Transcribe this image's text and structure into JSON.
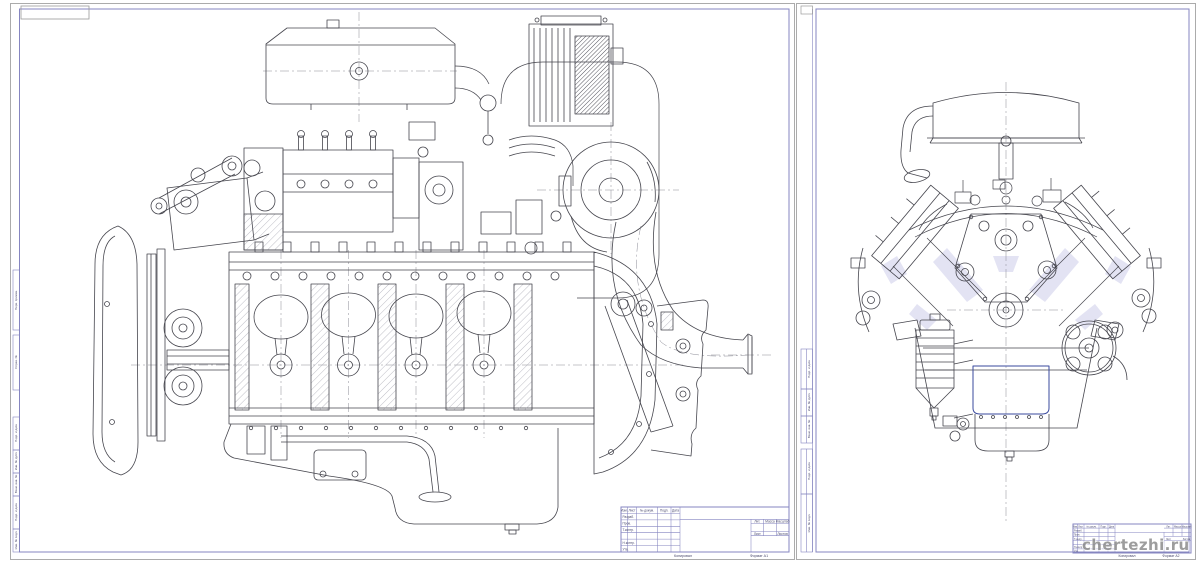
{
  "colors": {
    "background": "#ffffff",
    "frame_line": "#8585c0",
    "edge_line": "#a6a6a6",
    "drawing_line": "#46464e",
    "centerline": "#8b8b95",
    "accent_navy": "#3a4a9e",
    "hatch_tint": "#dfdff2",
    "watermark": "#8c8c8c"
  },
  "watermark": {
    "text": "chertezhi.ru"
  },
  "titleblock": {
    "header_cols": [
      "Изм.",
      "Лист",
      "№ докум.",
      "Подп.",
      "Дата"
    ],
    "role_rows": [
      "Разраб.",
      "Пров.",
      "Т.контр.",
      "Н.контр.",
      "Утв."
    ],
    "lit_cells": [
      "Лит.",
      "Масса",
      "Масштаб"
    ],
    "sheet_cells": [
      "Лист",
      "Листов"
    ]
  },
  "margin_labels": {
    "top": [
      "Перв. примен.",
      "Справ. №"
    ],
    "bottom": [
      "Подп. и дата",
      "Инв. № дубл.",
      "Взам. инв. №",
      "Подп. и дата",
      "Инв. № подл."
    ]
  },
  "footer": {
    "copy": "Копировал",
    "format_left": "Формат A1",
    "format_right": "Формат A2"
  }
}
